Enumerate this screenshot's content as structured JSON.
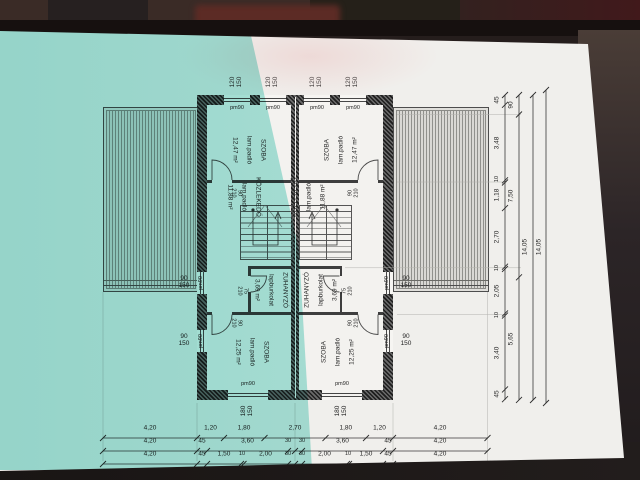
{
  "rooms": {
    "szoba_top": {
      "name": "SZOBA",
      "finish": "lam.padló",
      "area": "12,47 m²"
    },
    "kozlekedo": {
      "name": "KÖZLEKEDŐ",
      "finish": "lam.padló",
      "area": "11,88 m²"
    },
    "zuhanyzo": {
      "name": "ZUHANYZÓ",
      "finish": "lapburkolat",
      "area": "3,69 m²"
    },
    "szoba_bottom": {
      "name": "SZOBA",
      "finish": "lam.padló",
      "area": "12,25 m²"
    }
  },
  "openings": {
    "window_top": "120\n150",
    "window_side": "90\n150",
    "window_bottom": "180\n150",
    "door_room": "90\n210",
    "door_shower": "75\n210",
    "parapet": "pm90"
  },
  "dims": {
    "bottom_row1": [
      "4,20",
      "1,20",
      "1,80",
      "2,70",
      "1,80",
      "1,20",
      "4,20"
    ],
    "bottom_row2": [
      "4,20",
      "45",
      "3,60",
      "30",
      "30",
      "3,60",
      "45",
      "4,20"
    ],
    "bottom_row3": [
      "4,20",
      "45",
      "1,50",
      "10",
      "2,00",
      "30",
      "30",
      "2,00",
      "10",
      "1,50",
      "45",
      "4,20"
    ],
    "right_chain1": [
      "45",
      "3,48",
      "10",
      "1,18",
      "2,70",
      "10",
      "2,05",
      "10",
      "3,40",
      "45"
    ],
    "right_chain2": [
      "90",
      "7,50",
      "5,65"
    ],
    "right_totals": [
      "14,05",
      "14,05"
    ]
  }
}
